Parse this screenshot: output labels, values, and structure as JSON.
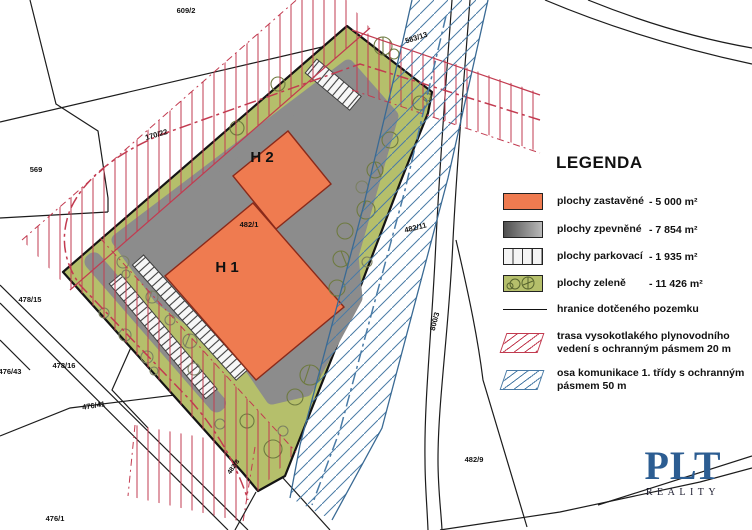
{
  "legend": {
    "title": "LEGENDA",
    "items": [
      {
        "label": "plochy zastavěné",
        "value": "- 5 000 m²"
      },
      {
        "label": "plochy zpevněné",
        "value": "- 7 854 m²"
      },
      {
        "label": "plochy parkovací",
        "value": "- 1 935 m²"
      },
      {
        "label": "plochy zeleně",
        "value": "- 11 426 m²"
      },
      {
        "label": "hranice dotčeného pozemku",
        "value": ""
      },
      {
        "line1": "trasa vysokotlakého plynovodního",
        "line2": "vedení s ochranným pásmem 20 m"
      },
      {
        "line1": "osa komunikace 1. třídy s ochranným",
        "line2": "pásmem 50 m"
      }
    ]
  },
  "buildings": {
    "h1": "H 1",
    "h2": "H 2"
  },
  "parcels": [
    "609/2",
    "583/13",
    "569",
    "170/22",
    "482/1",
    "482/11",
    "800/3",
    "478/15",
    "476/43",
    "478/16",
    "476/41",
    "476/1",
    "482/9",
    "482/8"
  ],
  "logo": {
    "name": "PLT",
    "subtitle": "REALITY"
  },
  "colors": {
    "built": "#ef7b50",
    "paved": "#8c8c8c",
    "green": "#b5bf6b",
    "gas_hatch": "#c23b50",
    "road_hatch": "#4a7ba6",
    "boundary": "#141414"
  }
}
